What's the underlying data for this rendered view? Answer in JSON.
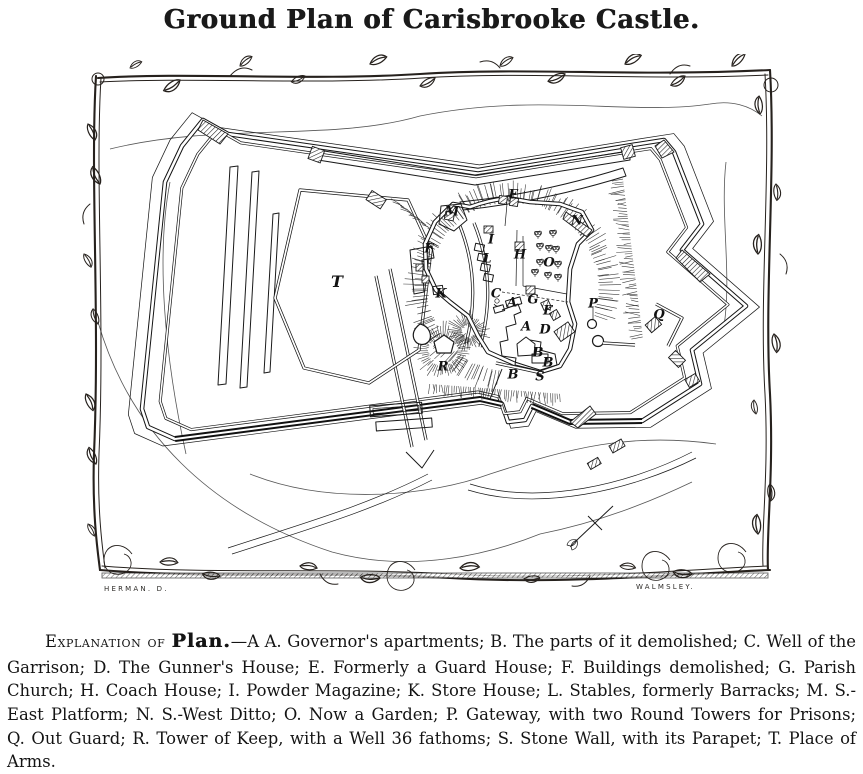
{
  "page": {
    "background": "#ffffff",
    "ink": "#1a1a1a"
  },
  "title": "Ground Plan of Carisbrooke Castle.",
  "engraving": {
    "credit_left": "HERMAN. D.",
    "credit_right": "WALMSLEY.",
    "labels": [
      {
        "letter": "T",
        "x": 267,
        "y": 228,
        "big": true
      },
      {
        "letter": "M",
        "x": 382,
        "y": 158
      },
      {
        "letter": "F",
        "x": 443,
        "y": 141
      },
      {
        "letter": "F",
        "x": 359,
        "y": 195
      },
      {
        "letter": "I",
        "x": 421,
        "y": 186
      },
      {
        "letter": "L",
        "x": 417,
        "y": 205
      },
      {
        "letter": "H",
        "x": 450,
        "y": 201
      },
      {
        "letter": "N",
        "x": 507,
        "y": 167
      },
      {
        "letter": "O",
        "x": 479,
        "y": 209
      },
      {
        "letter": "K",
        "x": 371,
        "y": 240
      },
      {
        "letter": "C",
        "x": 426,
        "y": 240
      },
      {
        "letter": "A",
        "x": 442,
        "y": 249
      },
      {
        "letter": "G",
        "x": 463,
        "y": 246
      },
      {
        "letter": "E",
        "x": 478,
        "y": 257
      },
      {
        "letter": "P",
        "x": 523,
        "y": 250
      },
      {
        "letter": "A",
        "x": 456,
        "y": 273
      },
      {
        "letter": "D",
        "x": 475,
        "y": 276
      },
      {
        "letter": "B",
        "x": 468,
        "y": 299
      },
      {
        "letter": "B",
        "x": 478,
        "y": 309
      },
      {
        "letter": "R",
        "x": 373,
        "y": 313
      },
      {
        "letter": "B",
        "x": 443,
        "y": 321
      },
      {
        "letter": "S",
        "x": 470,
        "y": 323
      },
      {
        "letter": "Q",
        "x": 589,
        "y": 261
      }
    ]
  },
  "explanation": {
    "heading_small_caps": "Explanation of",
    "heading_plan": "Plan.",
    "separator": "—",
    "entries": [
      {
        "key": "A A.",
        "text": "Governor's apartments"
      },
      {
        "key": "B.",
        "text": "The parts of it demolished"
      },
      {
        "key": "C.",
        "text": "Well of the Garrison"
      },
      {
        "key": "D.",
        "text": "The Gunner's House"
      },
      {
        "key": "E.",
        "text": "Formerly a Guard House"
      },
      {
        "key": "F.",
        "text": "Buildings demolished"
      },
      {
        "key": "G.",
        "text": "Parish Church"
      },
      {
        "key": "H.",
        "text": "Coach House"
      },
      {
        "key": "I.",
        "text": "Powder Magazine"
      },
      {
        "key": "K.",
        "text": "Store House"
      },
      {
        "key": "L.",
        "text": "Stables, formerly Barracks"
      },
      {
        "key": "M.",
        "text": "S.-East Platform"
      },
      {
        "key": "N.",
        "text": "S.-West Ditto"
      },
      {
        "key": "O.",
        "text": "Now a Garden"
      },
      {
        "key": "P.",
        "text": "Gateway, with two Round Towers for Prisons"
      },
      {
        "key": "Q.",
        "text": "Out Guard"
      },
      {
        "key": "R.",
        "text": "Tower of Keep, with a Well 36 fathoms"
      },
      {
        "key": "S.",
        "text": "Stone Wall, with its Parapet"
      },
      {
        "key": "T.",
        "text": "Place of Arms"
      }
    ],
    "terminator": "."
  }
}
